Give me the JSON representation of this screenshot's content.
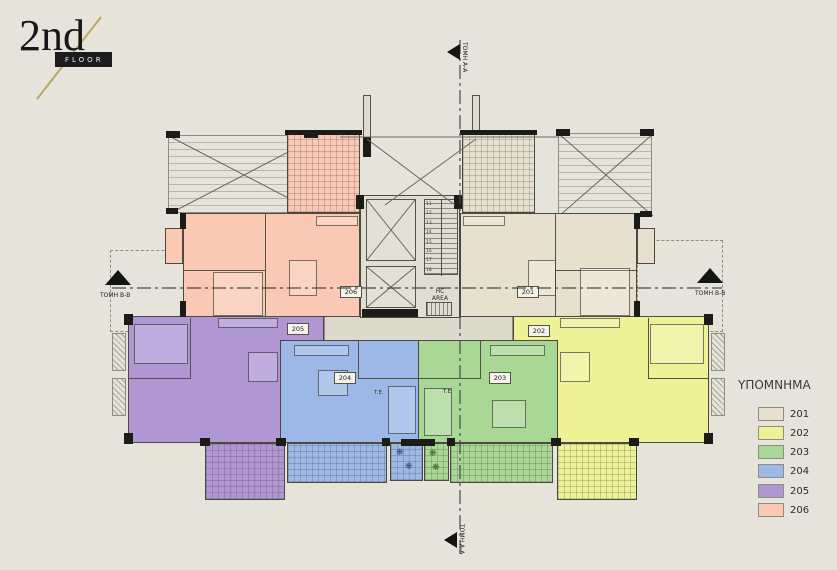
{
  "title": {
    "floor_number": "2nd",
    "floor_label": "FLOOR"
  },
  "legend": {
    "heading": "ΥΠΟΜΝΗΜΑ",
    "items": [
      {
        "label": "201",
        "color": "#e7e0cf"
      },
      {
        "label": "202",
        "color": "#eef196"
      },
      {
        "label": "203",
        "color": "#a9d795"
      },
      {
        "label": "204",
        "color": "#9cb8e6"
      },
      {
        "label": "205",
        "color": "#b097d4"
      },
      {
        "label": "206",
        "color": "#f9c9b3"
      }
    ]
  },
  "section_markers": {
    "left": "ΤΟΜΗ Β-Β",
    "right": "ΤΟΜΗ Β-Β",
    "top": "ΤΟΜΗ Α-Α",
    "bottom": "ΤΟΜΗ Α-Α"
  },
  "unit_tags": {
    "u201": "201",
    "u202": "202",
    "u203": "203",
    "u204": "204",
    "u205": "205",
    "u206": "206"
  },
  "core": {
    "hc_area_line1": "HC",
    "hc_area_line2": "AREA",
    "stair_numbers": [
      "11",
      "12",
      "13",
      "14",
      "15",
      "16",
      "17",
      "18"
    ]
  },
  "annotations": {
    "te_left": "T.E.",
    "te_right": "T.E."
  },
  "icons": {
    "plant": "❋"
  }
}
